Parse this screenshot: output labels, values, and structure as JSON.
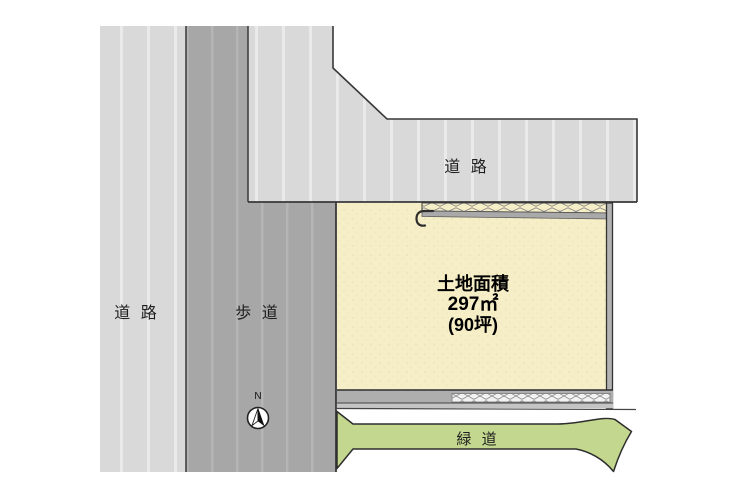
{
  "diagram": {
    "type": "real-estate-site-plan",
    "top_road_label": "道 路",
    "left_road_label": "道 路",
    "sidewalk_label": "歩 道",
    "green_way_label": "緑 道",
    "plot": {
      "title": "土地面積",
      "area_m2": "297㎡",
      "area_tsubo": "(90坪)"
    },
    "compass": {
      "north_label": "N"
    }
  },
  "colors": {
    "road_gray": "#d9d9d9",
    "sidewalk_gray": "#a7a7a7",
    "plot_cream": "#f6eec6",
    "green_way": "#c3d88e",
    "band_gray": "#aeaeae",
    "hatch_bg": "#f4f4f4",
    "outline_dark": "#2e2e2e"
  }
}
